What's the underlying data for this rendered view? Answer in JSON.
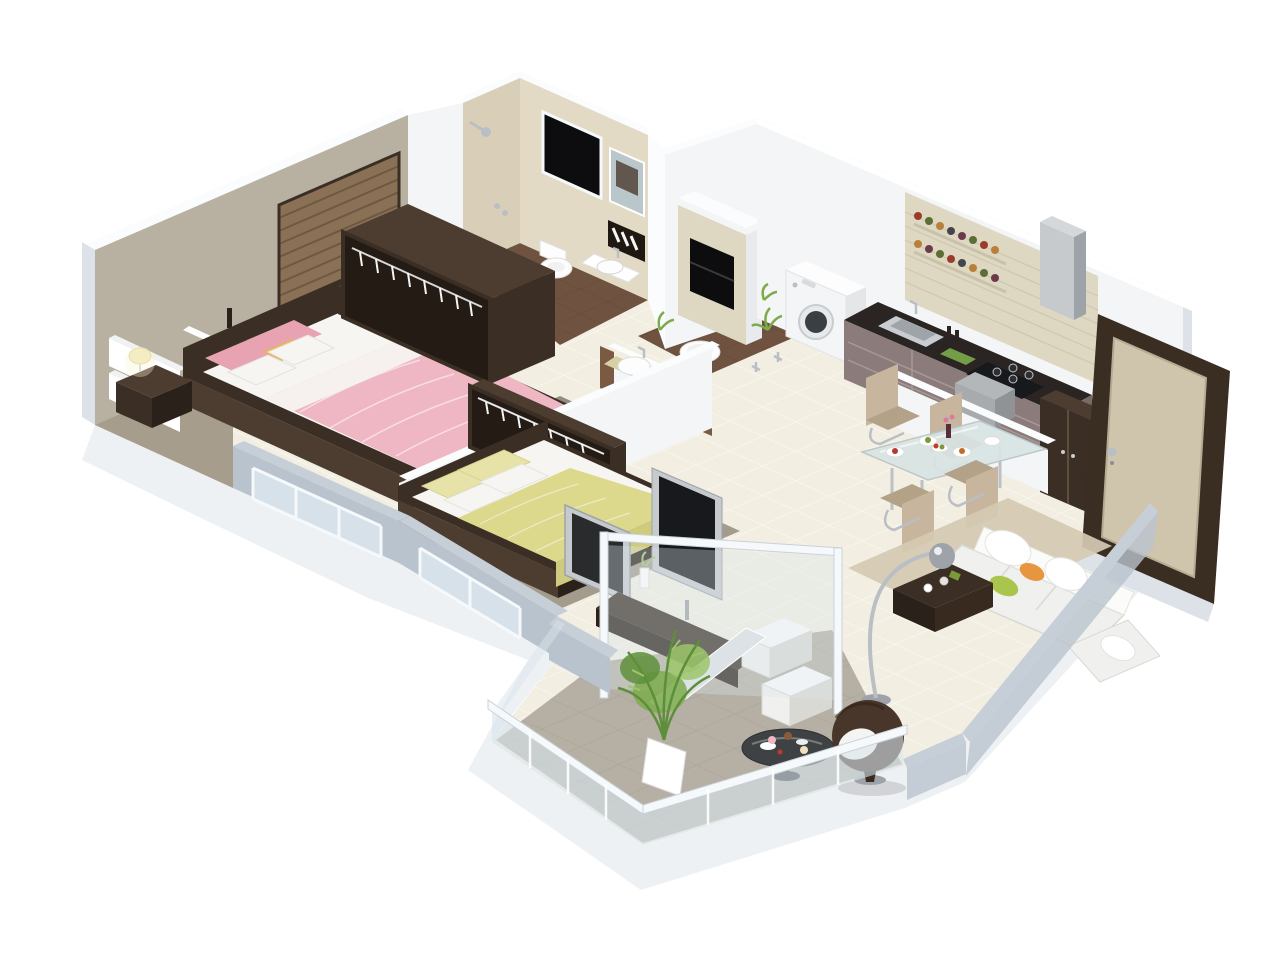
{
  "scene": {
    "type": "isometric-3d-floor-plan",
    "description": "3D cutaway render of a two-bedroom apartment floor plan on a white background",
    "rooms": [
      {
        "name": "Master Bedroom",
        "furniture": [
          "double bed with pink plaid bedding",
          "two dark nightstands with cream table lamps",
          "white wall shelves with vases",
          "brown venetian blind panel",
          "open dark wardrobe with hangers",
          "silver TV panel",
          "grey area rug"
        ]
      },
      {
        "name": "Bathroom",
        "furniture": [
          "shower head",
          "black window",
          "wall mirror",
          "towel rack",
          "wall-hung toilet",
          "washbasin",
          "brown tile floor"
        ]
      },
      {
        "name": "Second Bedroom",
        "furniture": [
          "double bed with yellow-green bedding",
          "open dark wardrobe with hangers",
          "TV panel",
          "books on ledge",
          "area rug"
        ]
      },
      {
        "name": "Hall Bathroom",
        "furniture": [
          "washbasin on counter",
          "oval basin",
          "wood trimmed half walls",
          "tiled column with black niche",
          "green plants"
        ]
      },
      {
        "name": "Utility",
        "furniture": [
          "washing machine",
          "potted plant"
        ]
      },
      {
        "name": "Kitchen",
        "furniture": [
          "dark granite counter",
          "steel sink",
          "four-burner gas hob",
          "steel chimney hood",
          "two spice racks with jars",
          "mauve cabinets",
          "tall dark cabinet",
          "grey block"
        ]
      },
      {
        "name": "Dining Area",
        "furniture": [
          "glass dining table with chrome legs",
          "four beige cantilever chairs",
          "plates of food",
          "fruit bowl",
          "flower vase",
          "white half wall"
        ]
      },
      {
        "name": "Living Room",
        "furniture": [
          "white L-shaped sofa",
          "green and orange accent pillows",
          "dark coffee table",
          "chrome arc floor lamp",
          "beige shag rug",
          "TV unit with flat screen",
          "two white ottomans",
          "glass partition"
        ]
      },
      {
        "name": "Balcony",
        "furniture": [
          "round dark glass table with desserts",
          "brown egg chair with white cushion",
          "leafy potted plant",
          "glass railing"
        ]
      },
      {
        "name": "Entrance",
        "furniture": [
          "dark wood entry door with beige panel and chrome handle"
        ]
      }
    ],
    "palette": {
      "bg": "#ffffff",
      "slabFace": "#eef1f4",
      "slabShade": "#dde2e8",
      "cutTop": "#c6cfd8",
      "cutFace": "#b9c3cd",
      "glassPane": "#d9e4ec",
      "glassFrame": "#f6f9fb",
      "wallWhite": "#f4f5f7",
      "wallBright": "#fbfcfd",
      "wallWhiteShade": "#e8eaee",
      "wallTaupe": "#b8b0a0",
      "wallTaupeDark": "#a69d8c",
      "wallBeige": "#d9cfb9",
      "wallBeigeLight": "#e3dac5",
      "splashBeige": "#ded7c2",
      "splashLine": "#cfc7ae",
      "floorTile": "#f2eee2",
      "floorBrown": "#6f5340",
      "floorBalcony": "#b5afa4",
      "rugMaster": "#8e8779",
      "rugBed2": "#9a9284",
      "rugBeige": "#d5cab2",
      "woodDark": "#3b2f25",
      "woodDarker": "#2a211a",
      "woodMid": "#4c3d30",
      "woodTrim": "#7a5a42",
      "wardrobeInner": "#231b14",
      "hanger": "#f5f5f5",
      "blinds": "#8a7156",
      "blindsDark": "#6e5843",
      "silver": "#c6cacd",
      "silverDark": "#9da3a8",
      "chrome": "#b9bfc4",
      "steel": "#c9cdd1",
      "steelDark": "#9ea4a8",
      "screenBlack": "#17191c",
      "nicheBlack": "#0d0d0f",
      "mirror": "#b9c6ca",
      "mirrorDark": "#4b3b2e",
      "towel": "#1f1812",
      "pinkBed": "#efb6c3",
      "pinkPillow": "#e8a3b2",
      "orangeAccent": "#efb05c",
      "whiteSoft": "#f6f5f2",
      "yellowBed": "#dcd88c",
      "yellowPale": "#e7e3a8",
      "yellowDark": "#cfcb7e",
      "greenPillow": "#a9c54d",
      "orangePillow": "#e8953f",
      "sofaWhite": "#f0f0ee",
      "sofaShade": "#d9d9d4",
      "chairBeige": "#c7b69d",
      "chairBeigeDark": "#b3a287",
      "lampCream": "#f4ecc2",
      "lampGlow": "#fdf6d8",
      "plantGreen": "#7cab4c",
      "plantGreenDark": "#5d8f3a",
      "plantGreenLight": "#9cc56a",
      "counterDark": "#2a2523",
      "cabinetMauve": "#8b7b7b",
      "cabinetMauveDark": "#7a6b6b",
      "greyCube": "#a7abae",
      "greyCubeDark": "#8f9396",
      "doorFrame": "#3a2d22",
      "doorPanel": "#cfc5ad",
      "applianceWhite": "#f4f5f6",
      "applianceShade": "#e4e6e8",
      "glassTable": "#d9e4e4",
      "basinCounter": "#d6d0a4",
      "brownChair": "#49362a",
      "brownChairDark": "#392a20",
      "fixtureWhite": "#fdfdfd",
      "fixtureStroke": "#d9d9d9",
      "jarRed": "#9a3b2b",
      "jarGreen": "#5c6e35",
      "jarAmber": "#b8803a",
      "jarDark": "#45464b",
      "jarPlum": "#6d3a4a"
    }
  }
}
